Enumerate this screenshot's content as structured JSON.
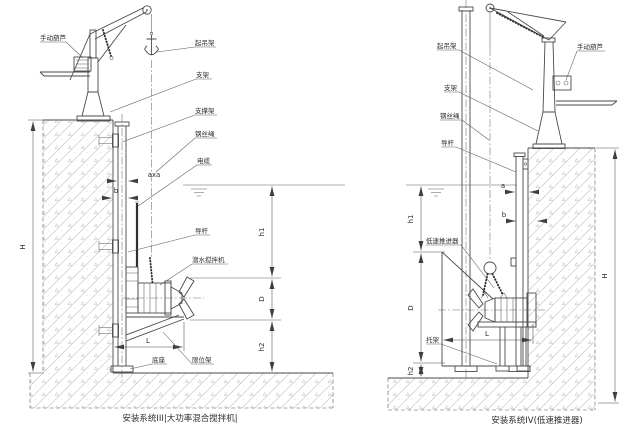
{
  "left": {
    "caption": "安装系统III|大功率混合搅拌机|",
    "labels": {
      "manual_hoist": "手动葫芦",
      "lifting_frame": "起吊架",
      "support": "支架",
      "support_bracket": "支撑架",
      "wire_rope": "钢丝绳",
      "cable": "电缆",
      "guide_rod": "导杆",
      "mixer": "潜水搅拌机",
      "base": "底座",
      "limit_frame": "限位架"
    },
    "dims": {
      "H": "H",
      "h1": "h1",
      "D": "D",
      "h2": "h2",
      "L": "L",
      "b": "b",
      "axa": "axa"
    }
  },
  "right": {
    "caption": "安装系统IV(低速推进器)",
    "labels": {
      "lifting_frame": "起吊架",
      "manual_hoist": "手动葫芦",
      "support": "支架",
      "wire_rope": "钢丝绳",
      "guide_rod": "导杆",
      "thruster": "低速推进器",
      "bracket": "托架"
    },
    "dims": {
      "H": "H",
      "h1": "h1",
      "D": "D",
      "h2": "h2",
      "L": "L",
      "a": "a",
      "b": "b"
    }
  }
}
